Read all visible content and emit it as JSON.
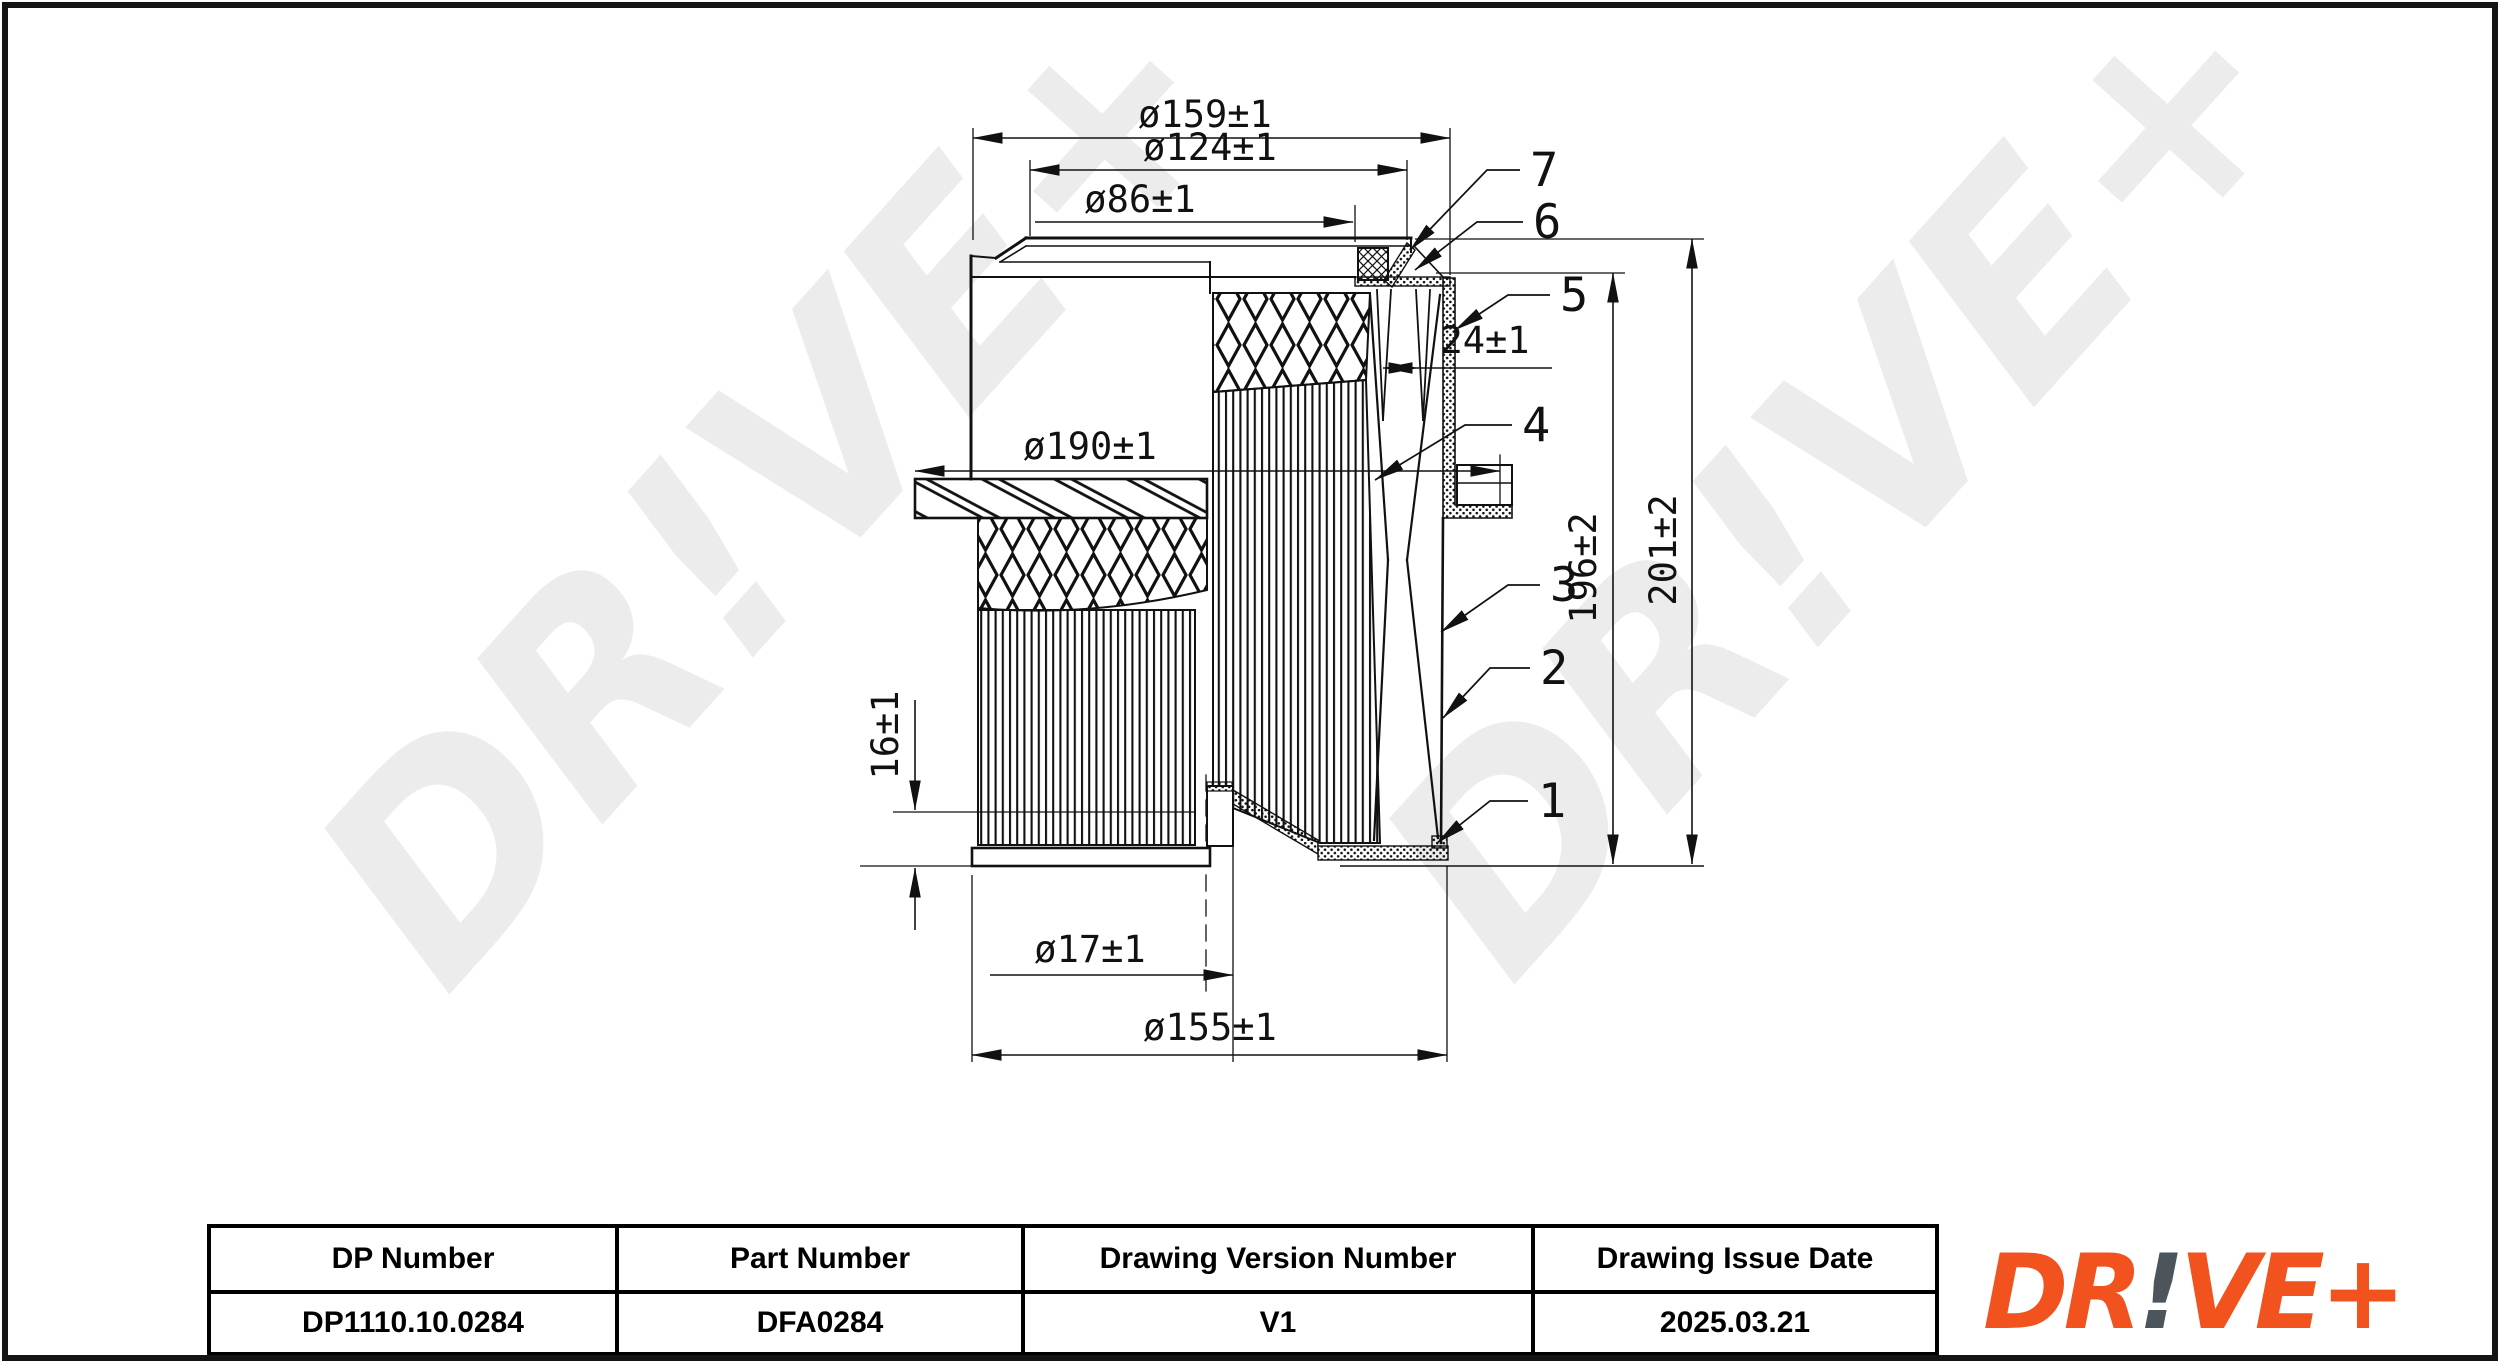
{
  "watermark": "DR!VE+",
  "drawing": {
    "dims": {
      "d159": "ø159±1",
      "d124": "ø124±1",
      "d86": "ø86±1",
      "d24": "24±1",
      "d190": "ø190±1",
      "d196": "196±2",
      "d201": "201±2",
      "d16": "16±1",
      "d17": "ø17±1",
      "d155": "ø155±1"
    },
    "callouts": {
      "c1": "1",
      "c2": "2",
      "c3": "3",
      "c4": "4",
      "c5": "5",
      "c6": "6",
      "c7": "7"
    }
  },
  "title_block": {
    "columns": [
      {
        "header": "DP Number",
        "value": "DP1110.10.0284"
      },
      {
        "header": "Part Number",
        "value": "DFA0284"
      },
      {
        "header": "Drawing Version Number",
        "value": "V1"
      },
      {
        "header": "Drawing Issue Date",
        "value": "2025.03.21"
      }
    ]
  },
  "logo": {
    "dr": "DR",
    "bang": "!",
    "veplus": "VE+"
  },
  "colors": {
    "logo_orange": "#F2521D",
    "logo_gray": "#4C555B",
    "watermark": "#ECECEC",
    "line": "#111111"
  }
}
